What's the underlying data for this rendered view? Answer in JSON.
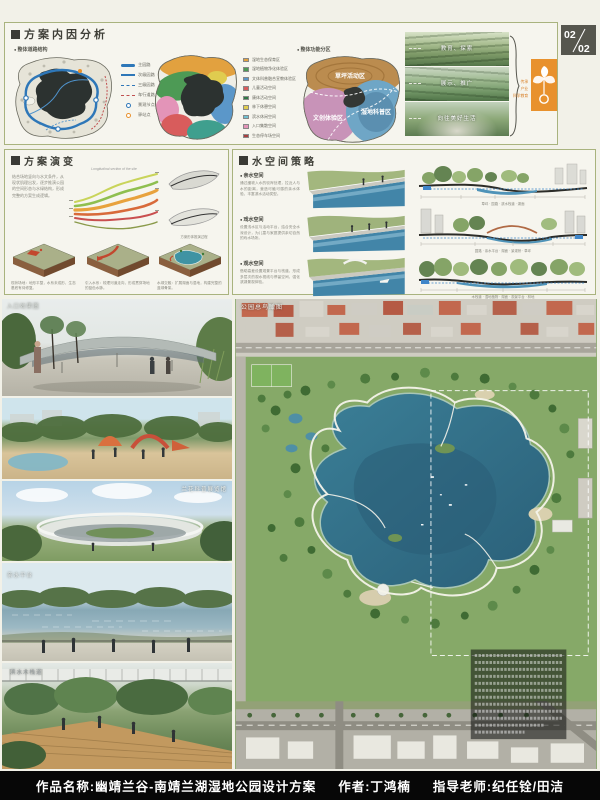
{
  "page_badge": {
    "current": "02",
    "total": "02"
  },
  "analysis": {
    "title": "方案内因分析",
    "road_structure_label": "整体道路结构",
    "function_zoning_label": "整体功能分区",
    "road_legend": [
      "主园路",
      "次级园路",
      "三级园路",
      "车行道路",
      "景观节点",
      "驿站点"
    ],
    "function_legend": [
      "湿地生态保育区",
      "湿地植物净化体验区",
      "文体科普融合宣教体验区",
      "儿童活动空间",
      "康体活动空间",
      "林下休憩空间",
      "滨水休闲空间",
      "入口集散空间",
      "生态停车场空间"
    ],
    "zone_labels": [
      "草坪活动区",
      "文创体验区",
      "湿地科普区"
    ],
    "photo_captions": [
      "教育、探索",
      "展示、推广",
      "向往美好生活"
    ],
    "concept_keywords": [
      "传承",
      "产业",
      "科学教育"
    ]
  },
  "evolution": {
    "title": "方案演变",
    "intro": "结合场地竖向与水文条件，从现状肌理出发，逐步推演公园的空间形态与水绿结构，形成完整的方案生成逻辑。",
    "diagram_title": "Longitudinal section of the site",
    "sketch_caption": "方案形体推演过程",
    "steps": [
      {
        "caption": "现状场地：地形平整，水系未成形，生态基底有待修复。"
      },
      {
        "caption": "引入水系：梳理河道走向，形成贯穿场地的蓝色水脉。"
      },
      {
        "caption": "水绿交融：扩展湖面与湿地，构建完整的蓝绿骨架。"
      }
    ]
  },
  "water": {
    "title": "水空间策略",
    "items": [
      {
        "label": "亲水空间",
        "text": "通过缓坡入水的驳岸处理，拉近人与水的距离，营造可触可感的亲水体验，丰富滨水活动类型。"
      },
      {
        "label": "戏水空间",
        "text": "设置浅水区与活动平台，结合安全水深设计，为儿童与家庭提供亲切自然的戏水场所。"
      },
      {
        "label": "观水空间",
        "text": "借助高差设置观景平台与栈道，形成多层次的观水视线与停留空间，强化滨湖景观体验。"
      }
    ],
    "section_labels": [
      "草坪 · 园路 · 滨水栈道 · 湖面",
      "园路 · 亲水平台 · 湖面 · 景观桥 · 草坪",
      "木栈道 · 湿地植物 · 湖面 · 观景平台 · 林地"
    ]
  },
  "renders": {
    "entrance": "入口效果图",
    "pavilion": "兰花科普展览馆",
    "platform": "亲水平台",
    "boardwalk": "滨水木栈道",
    "aerial_label": "公园总鸟瞰图"
  },
  "footer": {
    "project": "作品名称:幽靖兰谷-南靖兰湖湿地公园设计方案",
    "author": "作者:丁鸿楠",
    "advisor": "指导老师:纪任铨/田洁"
  }
}
